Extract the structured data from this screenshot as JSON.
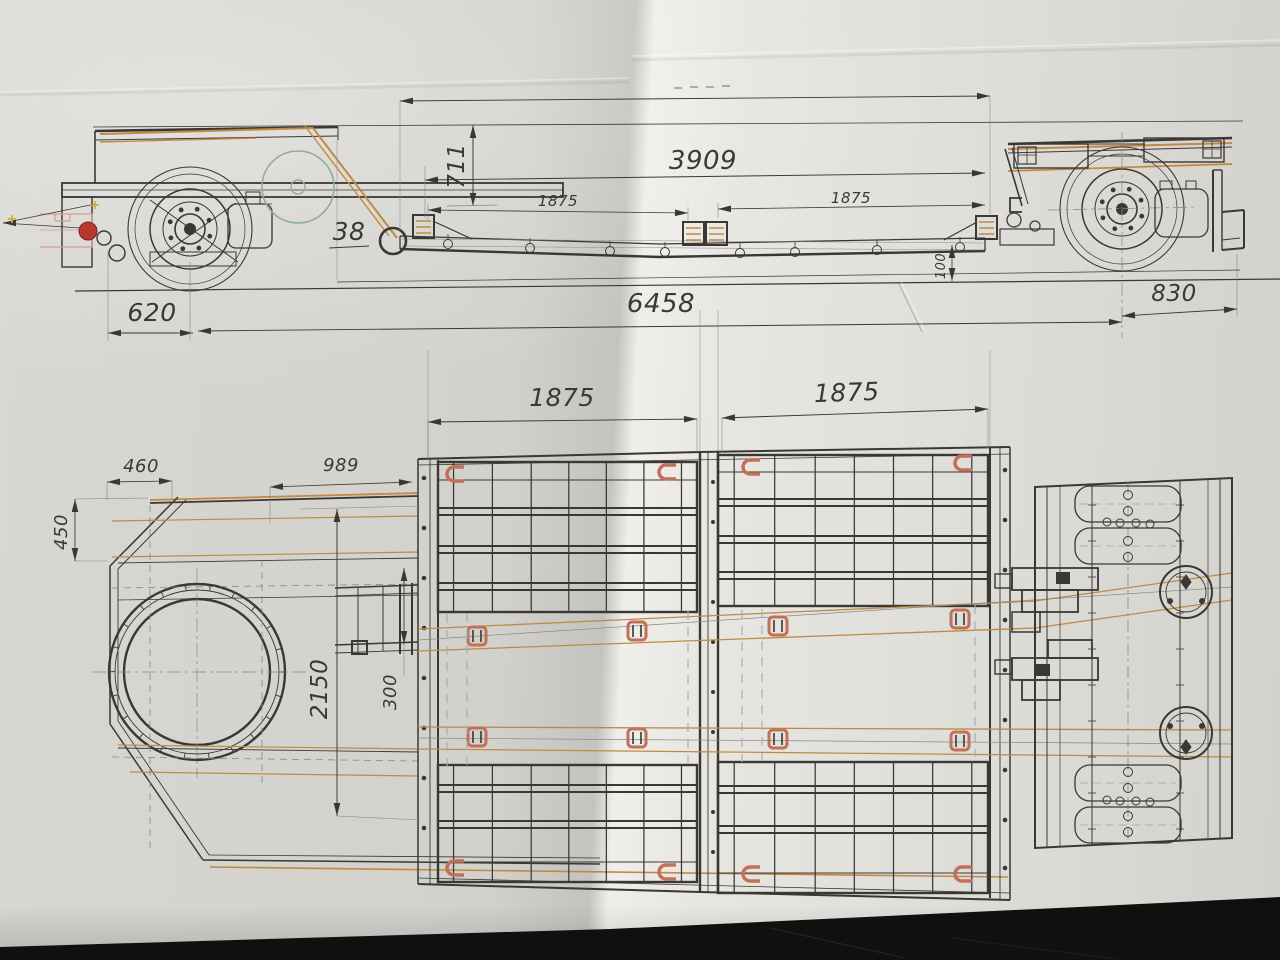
{
  "drawing": {
    "side_view": {
      "dim_3909": "3909",
      "dim_711": "711",
      "dim_38": "38",
      "dim_beam_left": "1875",
      "dim_beam_right": "1875",
      "dim_100": "100",
      "dim_620": "620",
      "dim_6458": "6458",
      "dim_830": "830"
    },
    "plan_view": {
      "dim_top_left": "1875",
      "dim_top_right": "1875",
      "dim_460": "460",
      "dim_989": "989",
      "dim_450": "450",
      "dim_2150": "2150",
      "dim_300": "300"
    },
    "colors": {
      "paper": "#d9d8d3",
      "background": "#0b0b0b",
      "ink": "#3a3835",
      "accent_tan": "#c08a45",
      "accent_bracket": "#c2705a",
      "accent_red": "#b5392c",
      "accent_green": "#8fae97",
      "hidden_blue": "#9fb0bc"
    }
  }
}
